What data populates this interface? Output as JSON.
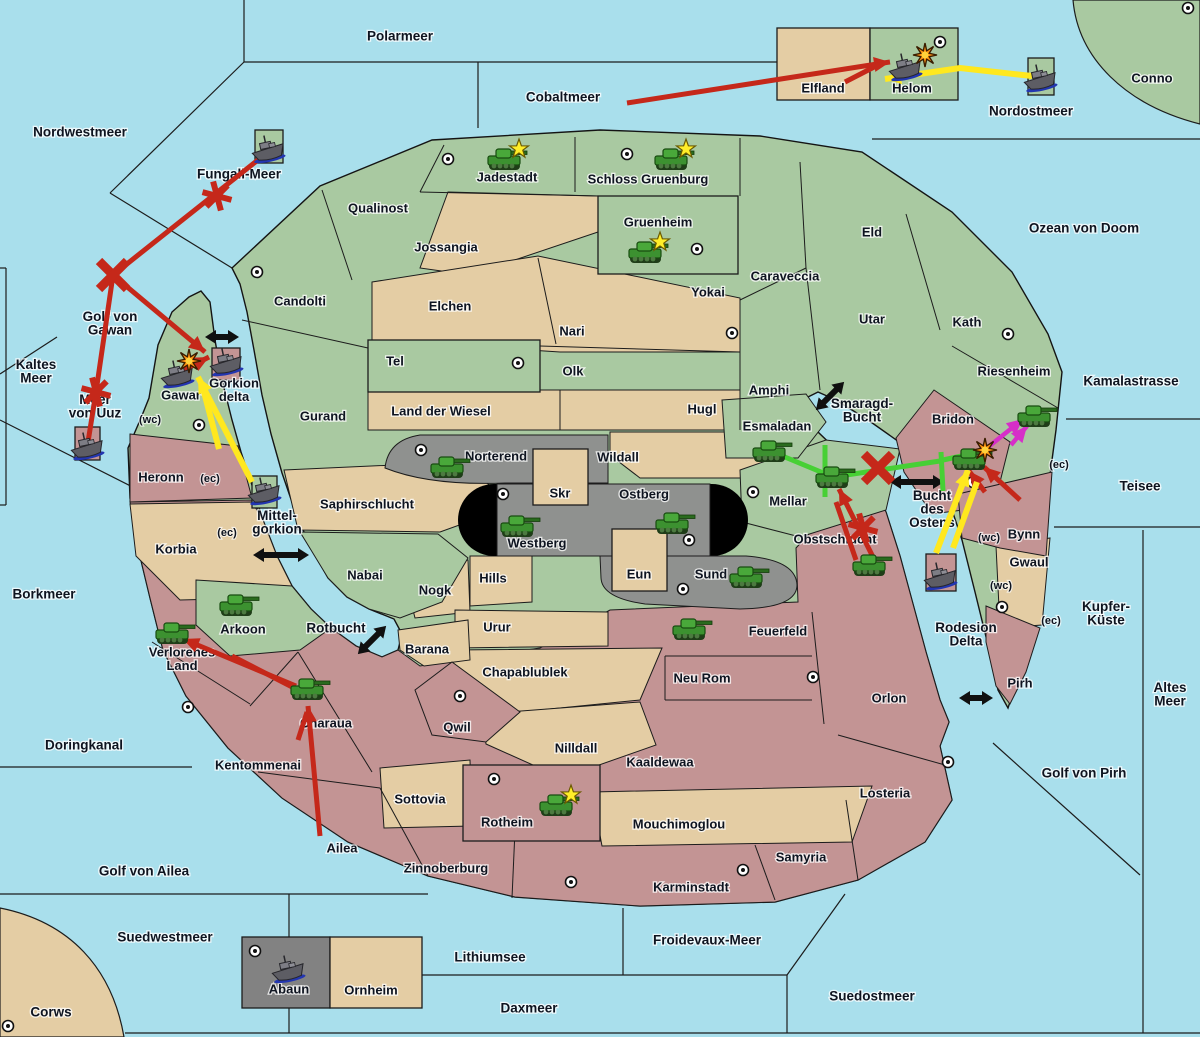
{
  "map": {
    "sea_color": "#a9dfec",
    "land_colors": {
      "green": "#a9c9a1",
      "tan": "#e4cda4",
      "gray": "#8f918f",
      "pink": "#c39494",
      "boxgray": "#828282",
      "mountain": "#000000"
    },
    "arrow_colors": {
      "red": "#c5281a",
      "yellow": "#ffe81f",
      "green": "#47d035",
      "magenta": "#d62fc8",
      "black": "#101010"
    }
  },
  "sea_labels": [
    {
      "name": "Polarmeer",
      "x": 400,
      "y": 37
    },
    {
      "name": "Nordwestmeer",
      "x": 80,
      "y": 133
    },
    {
      "name": "Cobaltmeer",
      "x": 563,
      "y": 98
    },
    {
      "name": "Nordostmeer",
      "x": 1031,
      "y": 112
    },
    {
      "name": "Fungali-Meer",
      "x": 239,
      "y": 175
    },
    {
      "name": "Ozean von Doom",
      "x": 1084,
      "y": 229
    },
    {
      "name": "Kaltes Meer",
      "x": 36,
      "y": 372,
      "lines": [
        "Kaltes",
        "Meer"
      ]
    },
    {
      "name": "Golf von Gawan",
      "x": 110,
      "y": 324,
      "lines": [
        "Golf von",
        "Gawan"
      ]
    },
    {
      "name": "Meer von Uuz",
      "x": 95,
      "y": 407,
      "lines": [
        "Meer",
        "von Uuz"
      ]
    },
    {
      "name": "Kamalastrasse",
      "x": 1131,
      "y": 382
    },
    {
      "name": "Smaragd-Bucht",
      "x": 862,
      "y": 411,
      "lines": [
        "Smaragd-",
        "Bucht"
      ]
    },
    {
      "name": "Teisee",
      "x": 1140,
      "y": 487
    },
    {
      "name": "Mittel-gorkion",
      "x": 277,
      "y": 523,
      "lines": [
        "Mittel-",
        "gorkion"
      ]
    },
    {
      "name": "Bucht des Ostens",
      "x": 932,
      "y": 510,
      "lines": [
        "Bucht",
        "des",
        "Ostens"
      ]
    },
    {
      "name": "Borkmeer",
      "x": 44,
      "y": 595
    },
    {
      "name": "Kupfer-Küste",
      "x": 1106,
      "y": 614,
      "lines": [
        "Kupfer-",
        "Küste"
      ]
    },
    {
      "name": "Rotbucht",
      "x": 336,
      "y": 629
    },
    {
      "name": "Rodesion Delta",
      "x": 966,
      "y": 635,
      "lines": [
        "Rodesion",
        "Delta"
      ]
    },
    {
      "name": "Altes Meer",
      "x": 1170,
      "y": 695,
      "lines": [
        "Altes",
        "Meer"
      ]
    },
    {
      "name": "Golf von Pirh",
      "x": 1084,
      "y": 774
    },
    {
      "name": "Doringkanal",
      "x": 84,
      "y": 746
    },
    {
      "name": "Golf von Ailea",
      "x": 144,
      "y": 872
    },
    {
      "name": "Suedwestmeer",
      "x": 165,
      "y": 938
    },
    {
      "name": "Froidevaux-Meer",
      "x": 707,
      "y": 941
    },
    {
      "name": "Lithiumsee",
      "x": 490,
      "y": 958
    },
    {
      "name": "Daxmeer",
      "x": 529,
      "y": 1009
    },
    {
      "name": "Suedostmeer",
      "x": 872,
      "y": 997
    },
    {
      "name": "Corws",
      "x": 51,
      "y": 1013
    }
  ],
  "territory_labels": [
    {
      "name": "Jadestadt",
      "x": 507,
      "y": 178
    },
    {
      "name": "Schloss Gruenburg",
      "x": 648,
      "y": 180
    },
    {
      "name": "Qualinost",
      "x": 378,
      "y": 209
    },
    {
      "name": "Jossangia",
      "x": 446,
      "y": 248
    },
    {
      "name": "Gruenheim",
      "x": 658,
      "y": 223
    },
    {
      "name": "Caraveccia",
      "x": 785,
      "y": 277
    },
    {
      "name": "Eld",
      "x": 872,
      "y": 233
    },
    {
      "name": "Yokai",
      "x": 708,
      "y": 293
    },
    {
      "name": "Candolti",
      "x": 300,
      "y": 302
    },
    {
      "name": "Elchen",
      "x": 450,
      "y": 307
    },
    {
      "name": "Utar",
      "x": 872,
      "y": 320
    },
    {
      "name": "Kath",
      "x": 967,
      "y": 323
    },
    {
      "name": "Nari",
      "x": 572,
      "y": 332
    },
    {
      "name": "Riesenheim",
      "x": 1014,
      "y": 372
    },
    {
      "name": "Tel",
      "x": 395,
      "y": 362
    },
    {
      "name": "Olk",
      "x": 573,
      "y": 372
    },
    {
      "name": "Amphi",
      "x": 769,
      "y": 391
    },
    {
      "name": "Gorkion delta",
      "x": 234,
      "y": 391,
      "lines": [
        "Gorkion",
        "delta"
      ]
    },
    {
      "name": "Gawar",
      "x": 181,
      "y": 396
    },
    {
      "name": "Land der Wiesel",
      "x": 441,
      "y": 412
    },
    {
      "name": "Hugl",
      "x": 702,
      "y": 410
    },
    {
      "name": "Gurand",
      "x": 323,
      "y": 417
    },
    {
      "name": "Esmaladan",
      "x": 777,
      "y": 427
    },
    {
      "name": "Bridon",
      "x": 953,
      "y": 420
    },
    {
      "name": "Norterend",
      "x": 496,
      "y": 457
    },
    {
      "name": "Wildall",
      "x": 618,
      "y": 458
    },
    {
      "name": "Heronn",
      "x": 161,
      "y": 478
    },
    {
      "name": "Skr",
      "x": 560,
      "y": 494
    },
    {
      "name": "Ostberg",
      "x": 644,
      "y": 495
    },
    {
      "name": "Mellar",
      "x": 788,
      "y": 502
    },
    {
      "name": "Saphirschlucht",
      "x": 367,
      "y": 505
    },
    {
      "name": "Westberg",
      "x": 537,
      "y": 544
    },
    {
      "name": "Obstschlucht",
      "x": 835,
      "y": 540
    },
    {
      "name": "Bynn",
      "x": 1024,
      "y": 535
    },
    {
      "name": "Korbia",
      "x": 176,
      "y": 550
    },
    {
      "name": "Gwaul",
      "x": 1029,
      "y": 563
    },
    {
      "name": "Eun",
      "x": 639,
      "y": 575
    },
    {
      "name": "Sund",
      "x": 711,
      "y": 575
    },
    {
      "name": "Hills",
      "x": 493,
      "y": 579
    },
    {
      "name": "Nabai",
      "x": 365,
      "y": 576
    },
    {
      "name": "Nogk",
      "x": 435,
      "y": 591
    },
    {
      "name": "Urur",
      "x": 497,
      "y": 628
    },
    {
      "name": "Arkoon",
      "x": 243,
      "y": 630
    },
    {
      "name": "Feuerfeld",
      "x": 778,
      "y": 632
    },
    {
      "name": "Barana",
      "x": 427,
      "y": 650
    },
    {
      "name": "Verlorenes Land",
      "x": 182,
      "y": 660,
      "lines": [
        "Verlorenes",
        "Land"
      ]
    },
    {
      "name": "Chapablublek",
      "x": 525,
      "y": 673
    },
    {
      "name": "Neu Rom",
      "x": 702,
      "y": 679
    },
    {
      "name": "Orlon",
      "x": 889,
      "y": 699
    },
    {
      "name": "Pirh",
      "x": 1020,
      "y": 684
    },
    {
      "name": "Charaua",
      "x": 326,
      "y": 724
    },
    {
      "name": "Qwil",
      "x": 457,
      "y": 728
    },
    {
      "name": "Nilldall",
      "x": 576,
      "y": 749
    },
    {
      "name": "Kaaldewaa",
      "x": 660,
      "y": 763
    },
    {
      "name": "Kentommenai",
      "x": 258,
      "y": 766
    },
    {
      "name": "Losteria",
      "x": 885,
      "y": 794
    },
    {
      "name": "Sottovia",
      "x": 420,
      "y": 800
    },
    {
      "name": "Rotheim",
      "x": 507,
      "y": 823
    },
    {
      "name": "Mouchimoglou",
      "x": 679,
      "y": 825
    },
    {
      "name": "Ailea",
      "x": 342,
      "y": 849
    },
    {
      "name": "Samyria",
      "x": 801,
      "y": 858
    },
    {
      "name": "Zinnoberburg",
      "x": 446,
      "y": 869
    },
    {
      "name": "Karminstadt",
      "x": 691,
      "y": 888
    },
    {
      "name": "Elfland",
      "x": 823,
      "y": 89
    },
    {
      "name": "Helom",
      "x": 912,
      "y": 89
    },
    {
      "name": "Abaun",
      "x": 289,
      "y": 990
    },
    {
      "name": "Ornheim",
      "x": 371,
      "y": 991
    },
    {
      "name": "Conno",
      "x": 1152,
      "y": 79
    }
  ],
  "small_markers": [
    {
      "text": "(wc)",
      "x": 150,
      "y": 420
    },
    {
      "text": "(ec)",
      "x": 210,
      "y": 479
    },
    {
      "text": "(ec)",
      "x": 227,
      "y": 533
    },
    {
      "text": "(ec)",
      "x": 1059,
      "y": 465
    },
    {
      "text": "(wc)",
      "x": 989,
      "y": 538
    },
    {
      "text": "(wc)",
      "x": 1001,
      "y": 586
    },
    {
      "text": "(ec)",
      "x": 1051,
      "y": 621
    }
  ],
  "dots": [
    [
      448,
      159
    ],
    [
      627,
      154
    ],
    [
      697,
      249
    ],
    [
      257,
      272
    ],
    [
      518,
      363
    ],
    [
      732,
      333
    ],
    [
      1008,
      334
    ],
    [
      1188,
      8
    ],
    [
      940,
      42
    ],
    [
      421,
      450
    ],
    [
      503,
      494
    ],
    [
      689,
      540
    ],
    [
      683,
      589
    ],
    [
      753,
      492
    ],
    [
      199,
      425
    ],
    [
      973,
      482
    ],
    [
      188,
      707
    ],
    [
      460,
      696
    ],
    [
      494,
      779
    ],
    [
      571,
      882
    ],
    [
      743,
      870
    ],
    [
      813,
      677
    ],
    [
      948,
      762
    ],
    [
      1002,
      607
    ],
    [
      255,
      951
    ],
    [
      8,
      1026
    ]
  ],
  "tanks": [
    {
      "x": 505,
      "y": 160,
      "star": true
    },
    {
      "x": 672,
      "y": 160,
      "star": true
    },
    {
      "x": 646,
      "y": 253,
      "star": true
    },
    {
      "x": 448,
      "y": 468
    },
    {
      "x": 518,
      "y": 527
    },
    {
      "x": 673,
      "y": 524
    },
    {
      "x": 747,
      "y": 578
    },
    {
      "x": 770,
      "y": 452
    },
    {
      "x": 833,
      "y": 478
    },
    {
      "x": 870,
      "y": 566
    },
    {
      "x": 690,
      "y": 630
    },
    {
      "x": 237,
      "y": 606
    },
    {
      "x": 173,
      "y": 634
    },
    {
      "x": 308,
      "y": 690
    },
    {
      "x": 557,
      "y": 806,
      "star": true
    },
    {
      "x": 970,
      "y": 460
    },
    {
      "x": 1035,
      "y": 417
    }
  ],
  "ships": [
    {
      "x": 268,
      "y": 150
    },
    {
      "x": 905,
      "y": 68
    },
    {
      "x": 1040,
      "y": 79
    },
    {
      "x": 177,
      "y": 375
    },
    {
      "x": 226,
      "y": 363
    },
    {
      "x": 264,
      "y": 492
    },
    {
      "x": 87,
      "y": 447
    },
    {
      "x": 940,
      "y": 577
    },
    {
      "x": 288,
      "y": 970
    }
  ],
  "explosions": [
    [
      925,
      55
    ],
    [
      189,
      361
    ],
    [
      985,
      450
    ]
  ],
  "stars": [
    [
      519,
      149
    ],
    [
      686,
      149
    ],
    [
      660,
      242
    ],
    [
      571,
      795
    ]
  ],
  "battle_marks": {
    "x": [
      [
        113,
        275
      ],
      [
        878,
        468
      ]
    ],
    "asterisk": [
      [
        217,
        196
      ],
      [
        96,
        392
      ],
      [
        863,
        528
      ]
    ]
  },
  "arrows": [
    {
      "color": "red",
      "pts": [
        [
          627,
          103
        ],
        [
          890,
          62
        ]
      ],
      "head": true
    },
    {
      "color": "red",
      "pts": [
        [
          845,
          82
        ],
        [
          880,
          64
        ]
      ],
      "head": false
    },
    {
      "color": "red",
      "pts": [
        [
          268,
          152
        ],
        [
          113,
          275
        ]
      ],
      "head": false
    },
    {
      "color": "red",
      "pts": [
        [
          113,
          275
        ],
        [
          96,
          392
        ],
        [
          88,
          442
        ]
      ],
      "head": false
    },
    {
      "color": "red",
      "pts": [
        [
          113,
          275
        ],
        [
          205,
          352
        ]
      ],
      "head": true
    },
    {
      "color": "red",
      "pts": [
        [
          182,
          371
        ],
        [
          209,
          357
        ]
      ],
      "head": true
    },
    {
      "color": "red",
      "pts": [
        [
          320,
          836
        ],
        [
          308,
          706
        ]
      ],
      "head": true
    },
    {
      "color": "red",
      "pts": [
        [
          298,
          740
        ],
        [
          307,
          712
        ]
      ],
      "head": false
    },
    {
      "color": "red",
      "pts": [
        [
          296,
          686
        ],
        [
          183,
          639
        ]
      ],
      "head": true
    },
    {
      "color": "red",
      "pts": [
        [
          298,
          690
        ],
        [
          232,
          656
        ]
      ],
      "head": false
    },
    {
      "color": "red",
      "pts": [
        [
          873,
          557
        ],
        [
          839,
          489
        ]
      ],
      "head": true
    },
    {
      "color": "red",
      "pts": [
        [
          856,
          560
        ],
        [
          836,
          502
        ]
      ],
      "head": false
    },
    {
      "color": "red",
      "pts": [
        [
          1020,
          500
        ],
        [
          984,
          467
        ]
      ],
      "head": true
    },
    {
      "color": "red",
      "pts": [
        [
          985,
          492
        ],
        [
          969,
          471
        ]
      ],
      "head": true
    },
    {
      "color": "yellow",
      "pts": [
        [
          1032,
          76
        ],
        [
          960,
          68
        ],
        [
          885,
          79
        ]
      ],
      "head": true
    },
    {
      "color": "yellow",
      "pts": [
        [
          252,
          482
        ],
        [
          198,
          377
        ]
      ],
      "head": true
    },
    {
      "color": "yellow",
      "pts": [
        [
          219,
          449
        ],
        [
          204,
          392
        ]
      ],
      "head": false
    },
    {
      "color": "yellow",
      "pts": [
        [
          936,
          553
        ],
        [
          968,
          470
        ]
      ],
      "head": true
    },
    {
      "color": "yellow",
      "pts": [
        [
          953,
          548
        ],
        [
          977,
          482
        ]
      ],
      "head": false
    },
    {
      "color": "green",
      "pts": [
        [
          780,
          455
        ],
        [
          833,
          477
        ]
      ],
      "head": false
    },
    {
      "color": "green",
      "pts": [
        [
          833,
          477
        ],
        [
          940,
          461
        ]
      ],
      "head": false
    },
    {
      "color": "green",
      "pts": [
        [
          825,
          445
        ],
        [
          825,
          497
        ]
      ],
      "head": false
    },
    {
      "color": "green",
      "pts": [
        [
          941,
          452
        ],
        [
          943,
          491
        ]
      ],
      "head": false
    },
    {
      "color": "green",
      "pts": [
        [
          943,
          460
        ],
        [
          966,
          455
        ]
      ],
      "head": false
    },
    {
      "color": "magenta",
      "pts": [
        [
          987,
          448
        ],
        [
          1023,
          419
        ]
      ],
      "head": true
    },
    {
      "color": "magenta",
      "pts": [
        [
          1011,
          445
        ],
        [
          1027,
          426
        ]
      ],
      "head": true
    }
  ],
  "double_arrows": [
    {
      "x": 222,
      "y": 337,
      "angle": 0,
      "len": 34
    },
    {
      "x": 281,
      "y": 555,
      "angle": 0,
      "len": 56
    },
    {
      "x": 830,
      "y": 396,
      "angle": -45,
      "len": 40
    },
    {
      "x": 372,
      "y": 640,
      "angle": -45,
      "len": 40
    },
    {
      "x": 917,
      "y": 482,
      "angle": 0,
      "len": 54
    },
    {
      "x": 976,
      "y": 698,
      "angle": 0,
      "len": 34
    }
  ]
}
